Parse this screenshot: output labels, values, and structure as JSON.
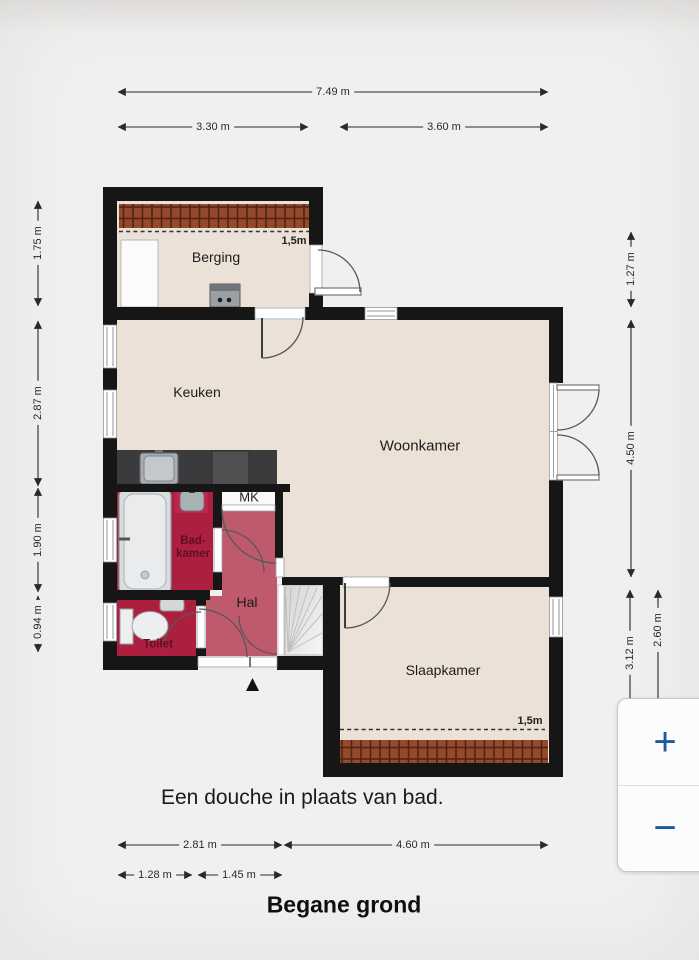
{
  "colors": {
    "background": "#f1f0ee",
    "floor": "#ebe1d7",
    "wall": "#161616",
    "wet_room": "#ad1f3e",
    "wet_room_accent": "#c2224a",
    "wet_room_label": "#5f0f22",
    "hall": "#bf5a6c",
    "brick": "#94492c",
    "brick_dark": "#4f2413",
    "counter": "#3b3b3d",
    "fixture": "#e9ebed",
    "fixture_stroke": "#8f969b",
    "stairs_line": "#bfbfc1",
    "door": "#55585b",
    "window_frame": "#8f969b",
    "dim": "#2a2a2a",
    "label": "#1c1c1c",
    "accent_blue": "#1d5a9d",
    "panel_bg": "#fcfcfd",
    "panel_border": "#c6c6c6"
  },
  "rooms": {
    "berging": "Berging",
    "keuken": "Keuken",
    "woonkamer": "Woonkamer",
    "slaapkamer": "Slaapkamer",
    "hal": "Hal",
    "mk": "MK",
    "toilet": "Toilet",
    "badkamer_line1": "Bad-",
    "badkamer_line2": "kamer"
  },
  "headroom": {
    "berging": "1,5m",
    "slaapkamer": "1,5m"
  },
  "dimensions": {
    "top_total": "7.49 m",
    "top_left": "3.30 m",
    "top_right": "3.60 m",
    "left_top": "1.75 m",
    "left_middle": "2.87 m",
    "left_lower": "1.90 m",
    "left_bottom": "0.94 m",
    "right_top": "1.27 m",
    "right_middle": "4.50 m",
    "right_lower": "3.12 m",
    "right_inner": "2.60 m",
    "bottom_left_total": "2.81 m",
    "bottom_right_total": "4.60 m",
    "bottom_seg_left": "1.28 m",
    "bottom_seg_right": "1.45 m"
  },
  "note": "Een douche in plaats van bad.",
  "title": "Begane grond",
  "zoom_controls": {
    "zoom_in": "+",
    "zoom_out": "−"
  }
}
